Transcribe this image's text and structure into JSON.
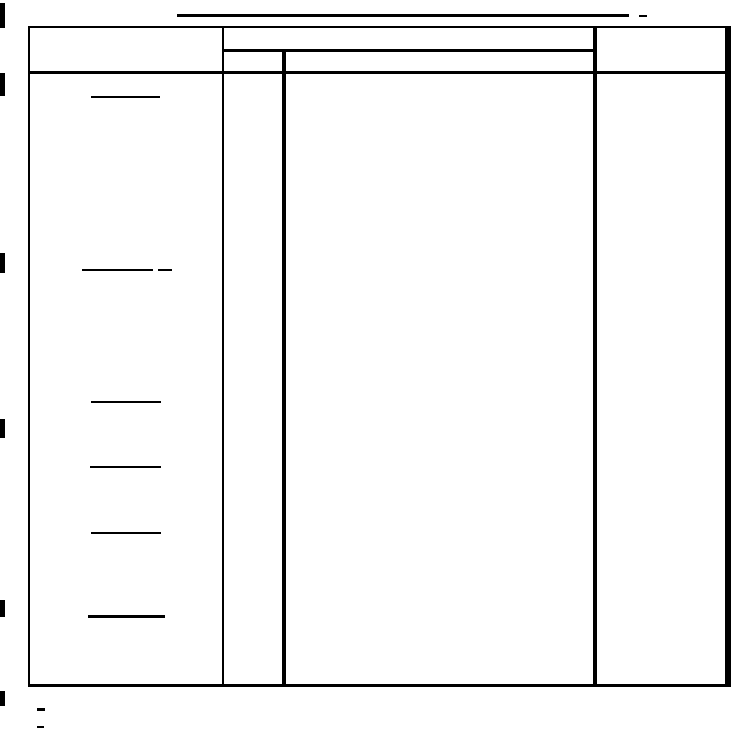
{
  "page": {
    "width": 731,
    "height": 731,
    "paper_color": "#ffffff",
    "ink_color": "#000000"
  },
  "document": {
    "kind": "scanned blank table form",
    "visible_text": "",
    "table": {
      "header_rows": 2,
      "columns": [
        "left-label-column",
        "narrow-sub-column",
        "wide-middle-column",
        "right-column"
      ],
      "all_cells_empty": true
    }
  },
  "marks": {
    "title_underline": {
      "x": 177,
      "y": 14,
      "width": 452,
      "height": 3
    },
    "title_dash": {
      "x": 639,
      "y": 15,
      "width": 8,
      "height": 2
    },
    "blank_lines": [
      {
        "x": 91,
        "y": 96,
        "width": 69,
        "height": 2
      },
      {
        "x": 82,
        "y": 269,
        "width": 71,
        "height": 2
      },
      {
        "x": 158,
        "y": 269,
        "width": 14,
        "height": 2
      },
      {
        "x": 91,
        "y": 401,
        "width": 70,
        "height": 2
      },
      {
        "x": 90,
        "y": 466,
        "width": 71,
        "height": 2
      },
      {
        "x": 91,
        "y": 532,
        "width": 70,
        "height": 2
      },
      {
        "x": 88,
        "y": 615,
        "width": 77,
        "height": 3
      }
    ],
    "margin_marks": [
      {
        "x": 0,
        "y": 3,
        "width": 5,
        "height": 25
      },
      {
        "x": 0,
        "y": 73,
        "width": 5,
        "height": 23
      },
      {
        "x": 0,
        "y": 253,
        "width": 5,
        "height": 20
      },
      {
        "x": 0,
        "y": 419,
        "width": 5,
        "height": 19
      },
      {
        "x": 0,
        "y": 600,
        "width": 5,
        "height": 17
      },
      {
        "x": 0,
        "y": 691,
        "width": 5,
        "height": 15
      }
    ],
    "footnote_dashes": [
      {
        "x": 37,
        "y": 708,
        "width": 8,
        "height": 3
      },
      {
        "x": 37,
        "y": 726,
        "width": 7,
        "height": 2
      }
    ]
  }
}
